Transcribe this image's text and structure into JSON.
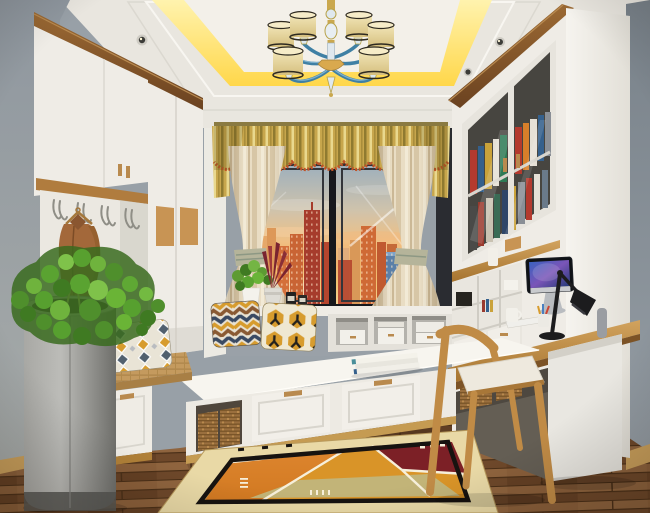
{
  "meta": {
    "type": "photograph",
    "subject": "3D interior rendering of a small study bedroom at sunset, with window seat, wardrobe, desk and chandelier"
  },
  "colors": {
    "wall": "#98a0a7",
    "wallRight": "#848d95",
    "ceiling": "#f3f0e9",
    "cove": "#ffd74a",
    "molding": "#e9e6df",
    "furniture": "#efece6",
    "furnitureShade": "#e0ddd5",
    "oak": "#c89454",
    "walnut": "#8a5a2e",
    "floor": "#7c5433",
    "curtain": "#e9ddc4",
    "valanceGold": "#c7a64c",
    "fringe": "#c05327",
    "skyTop": "#9fb0bc",
    "sunset": "#f2a452",
    "sun": "#fff6cf",
    "cityRed": "#a63c2c",
    "cityOrange": "#d4703a",
    "cityBlue": "#5b80a8",
    "windowFrame": "#17181c",
    "seatBack": "#9aa1a8",
    "rugCream": "#e9d9a6",
    "rugOrange": "#e07b1e",
    "rugMaroon": "#7c2026",
    "rugOlive": "#c2b478",
    "rugBlack": "#171310",
    "pillowGold": "#d79c2e",
    "pillowNavy": "#475a70",
    "pillowCream": "#e9e2d2",
    "chandelierBlue": "#3f80a4",
    "shadeCream": "#e9d9a2",
    "plantGreen": "#5d9b33",
    "plantDark": "#3f7a22",
    "basket": "#9a6f3e",
    "rattan": "#c49a5e",
    "chairWood": "#c08b46",
    "planterGray": "#8f8f8b",
    "screenBlue": "#3a62c0",
    "lampBlack": "#1c1c1e",
    "coat": "#a3683a"
  },
  "scene": {
    "description": "Interior room at sunset: white tray ceiling with yellow LED cove and blue chandelier, black picture window over a city skyline, cream curtains with gold valance, white window seat with pillows and storage, left wardrobe nook with coat hooks and plant, right built-in bookcase and oak desk with monitor and lamp, wood floor with geometric rug",
    "ceiling": {
      "label": "white tray ceiling with warm yellow LED cove lighting and stepped crown molding",
      "spotlight_count": 3
    },
    "chandelier": {
      "label": "blue glass chandelier with cream drum shades",
      "shade_count": 8
    },
    "window": {
      "label": "black aluminum picture window, two panes",
      "view": "sunset city skyline with high-rise towers, jet contrails and low sun"
    },
    "window_treatments": {
      "valance": "gold striped valance with red fringe",
      "curtains": "cream tie-back curtains"
    },
    "window_seat": {
      "label": "white window seat with storage",
      "drawer_count": 2,
      "basket_count": 4,
      "pillows": [
        "multicolor chevron pillow",
        "gold and black geometric pillow"
      ],
      "items": [
        "stack of books"
      ]
    },
    "windowsill_items": [
      "green potted plant",
      "dark red plant in vase",
      "two black candle jars"
    ],
    "left_side": {
      "upper_cabinet": "white wall cabinet with walnut trim",
      "coat_hooks": 4,
      "hanging_item": "brown coat on wooden hanger",
      "wardrobe": "white sliding-door wardrobe with oak inlays",
      "bench": "rattan-topped storage bench",
      "bench_pillow": "gold, navy and gray diamond pillow",
      "planter": "tall gray cylinder planter with green shrub"
    },
    "right_side": {
      "bookcase": "white glass-door bookcase filled with books",
      "desk": "built-in oak desk",
      "desk_items": [
        "monitor",
        "black task lamp",
        "white keyboard",
        "mug",
        "pencil cup",
        "speaker"
      ],
      "chair": "oak chair with white cushion"
    },
    "floor": "warm brown wood plank floor",
    "rug": "geometric area rug in orange, maroon, olive and cream with black border"
  }
}
